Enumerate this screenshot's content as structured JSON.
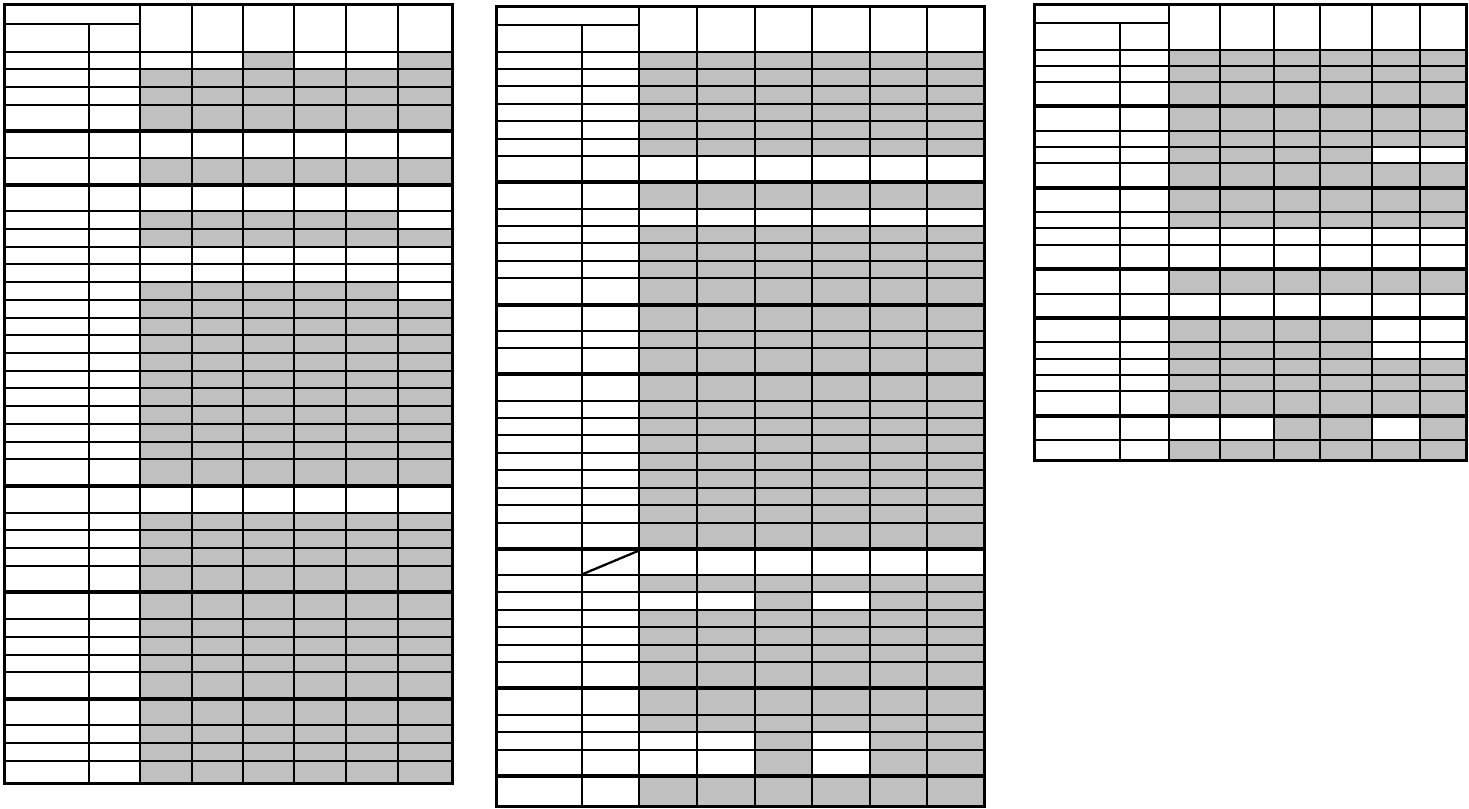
{
  "document": {
    "description": "Blank worksheet page with three grid tables of shaded and blank cells",
    "background_color": "#ffffff",
    "line_color": "#000000",
    "shaded_cell_color": "#c0c0c0",
    "blank_cell_color": "#ffffff"
  },
  "shading_legend": {
    "G": "shaded",
    "W": "blank"
  },
  "tables": [
    {
      "id": "left-table",
      "geometry": {
        "x": 3,
        "y": 3,
        "width": 449,
        "height": 782
      },
      "label_col_widths": [
        84,
        51
      ],
      "data_col_widths": [
        52,
        51,
        51,
        52,
        52,
        55
      ],
      "header": {
        "merged_top_cell": "",
        "sub_cells": [
          "",
          ""
        ],
        "data_cells": [
          "",
          "",
          "",
          "",
          "",
          ""
        ],
        "top_row_height": 19,
        "sub_row_height": 28
      },
      "rows": [
        "WWGWWG",
        "GGGGGG",
        "GGGGGG",
        "GGGGGG",
        "WWWWWW",
        "GGGGGG",
        "WWWWWW",
        "GGGGGW",
        "GGGGGG",
        "WWWWWW",
        "WWWWWW",
        "GGGGGW",
        "GGGGGG",
        "GGGGGG",
        "GGGGGG",
        "GGGGGG",
        "GGGGGG",
        "GGGGGG",
        "GGGGGG",
        "GGGGGG",
        "GGGGGG",
        "GGGGGG",
        "WWWWWW",
        "GGGGGG",
        "GGGGGG",
        "GGGGGG",
        "GGGGGG",
        "GGGGGG",
        "GGGGGG",
        "GGGGGG",
        "GGGGGG",
        "GGGGGG",
        "GGGGGG",
        "GGGGGG",
        "GGGGGG",
        "GGGGGG"
      ],
      "thick_borders_after_rows": [
        4,
        6,
        22,
        27,
        32
      ],
      "special": {
        "label1_thick_bottom_after_row": 15
      }
    },
    {
      "id": "middle-table",
      "geometry": {
        "x": 495,
        "y": 5,
        "width": 488,
        "height": 803
      },
      "label_col_widths": [
        85,
        57
      ],
      "data_col_widths": [
        58,
        58,
        57,
        58,
        57,
        58
      ],
      "header": {
        "merged_top_cell": "",
        "sub_cells": [
          "",
          ""
        ],
        "data_cells": [
          "",
          "",
          "",
          "",
          "",
          ""
        ],
        "top_row_height": 18,
        "sub_row_height": 27
      },
      "rows": [
        "GGGGGG",
        "GGGGGG",
        "GGGGGG",
        "GGGGGG",
        "GGGGGG",
        "GGGGGG",
        "WWWWWW",
        "GGGGGG",
        "WWWWWW",
        "GGGGGG",
        "GGGGGG",
        "GGGGGG",
        "GGGGGG",
        "GGGGGG",
        "GGGGGG",
        "GGGGGG",
        "GGGGGG",
        "GGGGGG",
        "GGGGGG",
        "GGGGGG",
        "GGGGGG",
        "GGGGGG",
        "GGGGGG",
        "GGGGGG",
        "GGGGGG",
        "WWWWWW",
        "GGGGGG",
        "WWGWGG",
        "GGGGGG",
        "GGGGGG",
        "GGGGGG",
        "GGGGGG",
        "GGGGGG",
        "GGGGGG",
        "WWGWGG",
        "WWGWGG",
        "GGGGGG"
      ],
      "thick_borders_after_rows": [
        7,
        13,
        16,
        25,
        32,
        36
      ],
      "special": {
        "diagonal_slash_label2_row": 26
      }
    },
    {
      "id": "right-table",
      "geometry": {
        "x": 1033,
        "y": 3,
        "width": 432,
        "height": 459
      },
      "label_col_widths": [
        85,
        49
      ],
      "data_col_widths": [
        51,
        54,
        46,
        52,
        48,
        47
      ],
      "header": {
        "merged_top_cell": "",
        "sub_cells": [
          "",
          ""
        ],
        "data_cells": [
          "",
          "",
          "",
          "",
          "",
          ""
        ],
        "top_row_height": 18,
        "sub_row_height": 27
      },
      "rows": [
        "GGGGGG",
        "GGGGGG",
        "GGGGGG",
        "GGGGGG",
        "GGGGGG",
        "GGGGWW",
        "GGGGGG",
        "GGGGGG",
        "GGGGGG",
        "WWWWWW",
        "WWWWWW",
        "GGGGGG",
        "WWWWWW",
        "GGGGWW",
        "GGGGWW",
        "GGGGGG",
        "GGGGGG",
        "GGGGGG",
        "WWGGWG",
        "GGGGGG"
      ],
      "thick_borders_after_rows": [
        3,
        7,
        11,
        13,
        18
      ],
      "special": {
        "thick_vertical_before_data_col": 4
      }
    }
  ]
}
